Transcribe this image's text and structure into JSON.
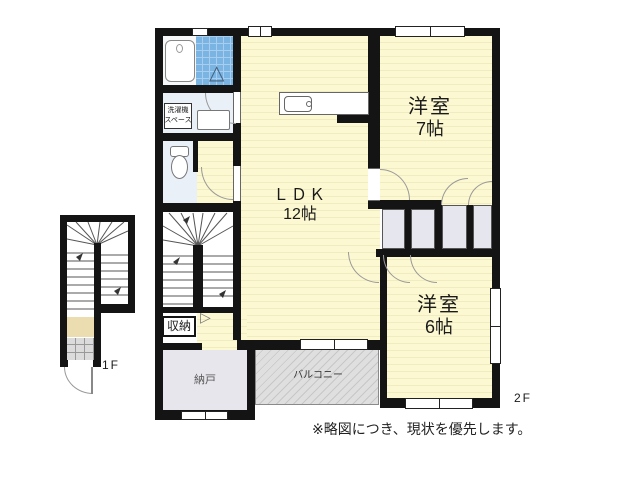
{
  "floors": {
    "first": "1F",
    "second": "2F"
  },
  "rooms": {
    "ldk": {
      "name": "ＬＤＫ",
      "size": "12帖"
    },
    "western7": {
      "name": "洋室",
      "size": "7帖"
    },
    "western6": {
      "name": "洋室",
      "size": "6帖"
    },
    "closet": {
      "name": "収納"
    },
    "storeroom": {
      "name": "納戸"
    },
    "balcony": {
      "name": "バルコニー"
    },
    "laundry": {
      "line1": "洗濯機",
      "line2": "スペース"
    }
  },
  "note": "※略図につき、現状を優先します。",
  "fixtures": [
    "bathtub",
    "bath-tile",
    "folding-door",
    "toilet",
    "washbasin",
    "kitchen-sink",
    "staircase-2f",
    "staircase-1f",
    "entrance-tile"
  ],
  "colors": {
    "wall": "#141414",
    "room_yellow": "#FBF8D2",
    "tile_blue": "#79B4E3",
    "wet_area_blue": "#E9F0F8",
    "closet_gray": "#E6E6EC",
    "balcony_gray": "#DFDFDF",
    "hall_tan_1f": "#EBDDB0"
  }
}
